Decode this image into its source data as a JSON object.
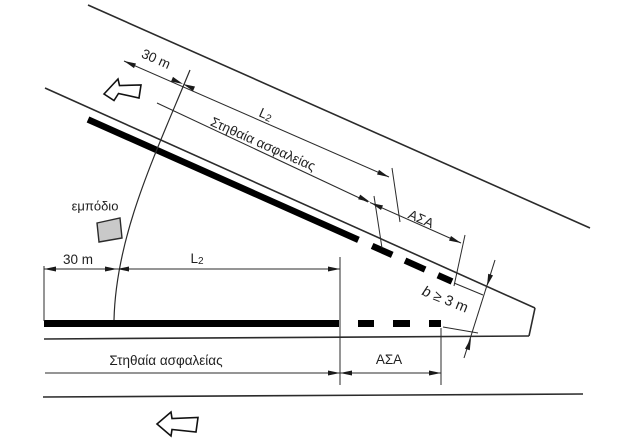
{
  "diagram": {
    "colors": {
      "background": "#ffffff",
      "line": "#2b2b2b",
      "barrier": "#000000",
      "obstacle_fill": "#c9c9c9"
    },
    "labels": {
      "ramp_setback": "30 m",
      "ramp_length_l": "L",
      "ramp_length_sub": "2",
      "ramp_guardrail": "Στηθαία ασφαλείας",
      "ramp_terminal": "ΑΣΑ",
      "obstacle": "εμπόδιο",
      "main_setback": "30 m",
      "main_length_l": "L",
      "main_length_sub": "2",
      "main_guardrail": "Στηθαία ασφαλείας",
      "main_terminal": "ΑΣΑ",
      "gore_width_var": "b",
      "gore_width_constraint": "≥ 3 m"
    }
  }
}
